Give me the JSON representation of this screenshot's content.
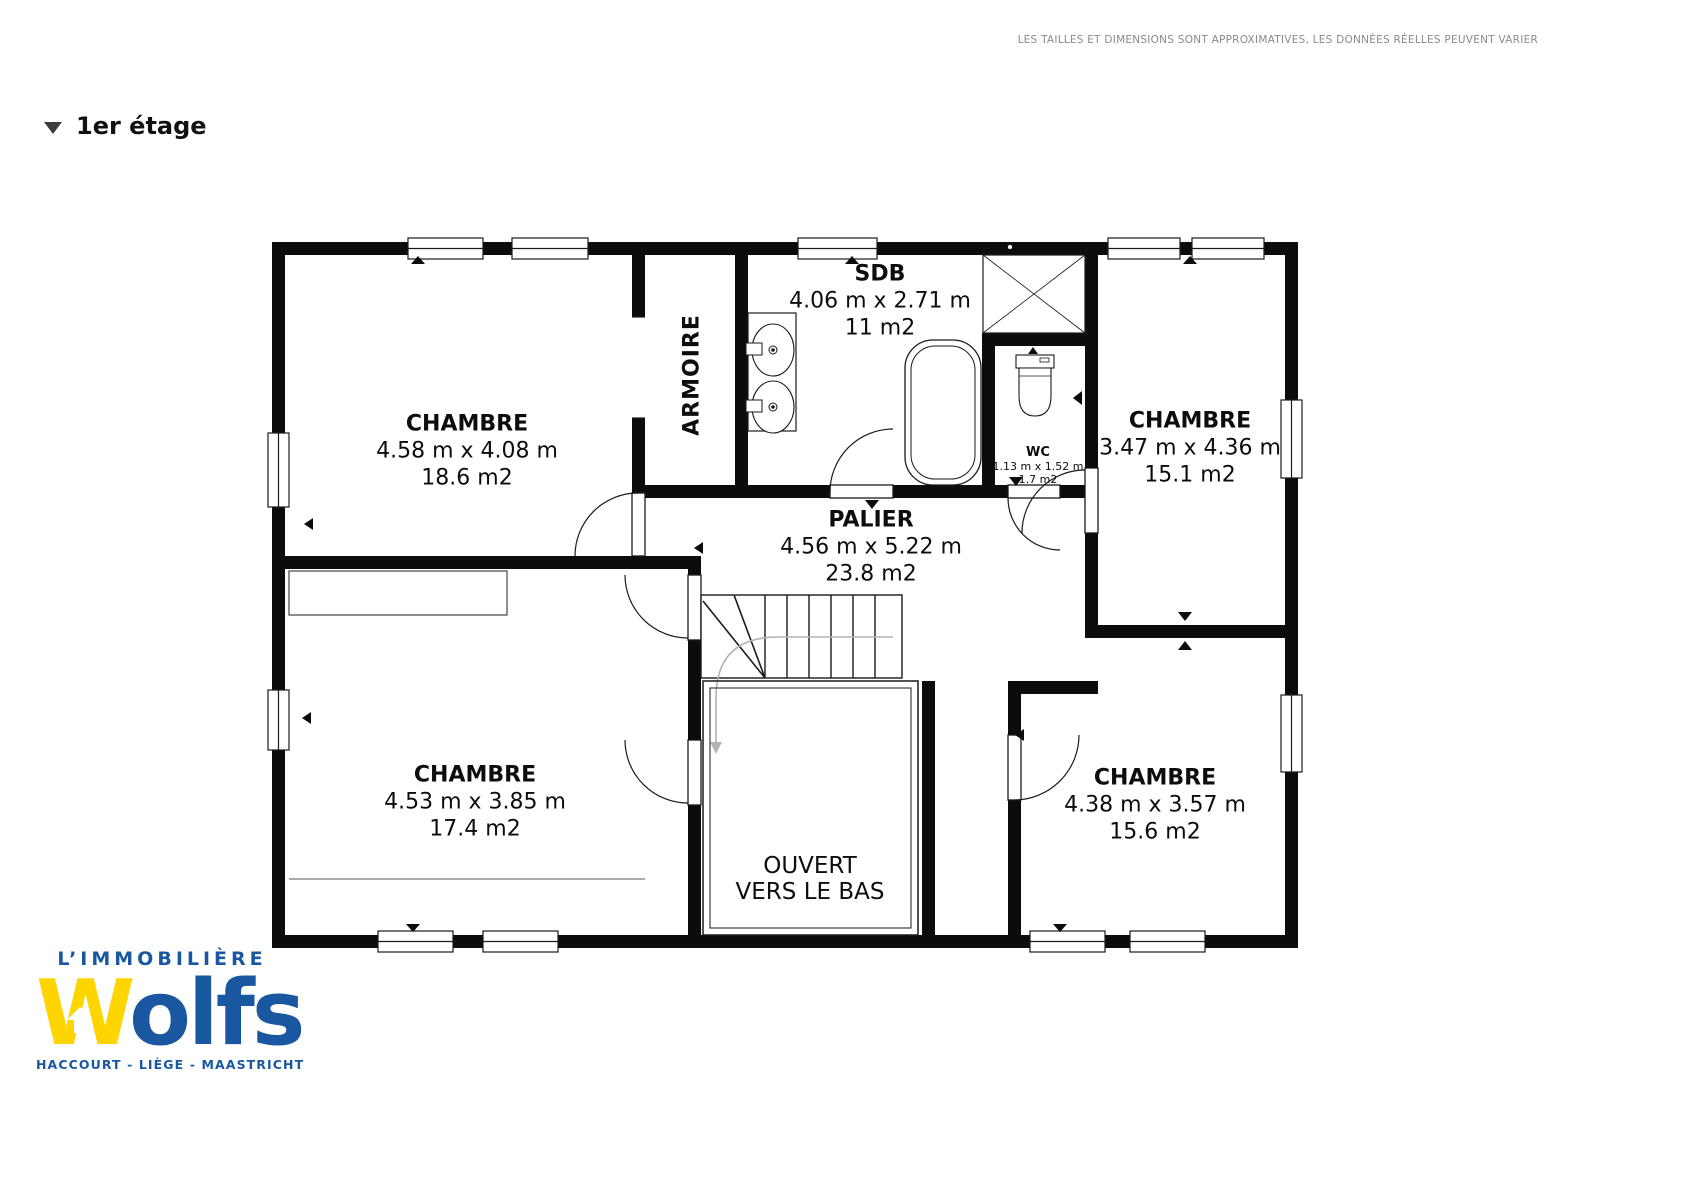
{
  "disclaimer": "LES TAILLES ET DIMENSIONS SONT APPROXIMATIVES, LES DONNÉES RÉELLES PEUVENT VARIER",
  "floor_selector": {
    "label": "1er étage"
  },
  "plan": {
    "rooms": [
      {
        "id": "chambre-top-left",
        "name": "CHAMBRE",
        "dims": "4.58 m x 4.08 m",
        "area": "18.6 m2"
      },
      {
        "id": "sdb",
        "name": "SDB",
        "dims": "4.06 m x 2.71 m",
        "area": "11 m2"
      },
      {
        "id": "wc",
        "name": "WC",
        "dims": "1.13 m x 1.52 m",
        "area": "1.7 m2"
      },
      {
        "id": "chambre-top-right",
        "name": "CHAMBRE",
        "dims": "3.47 m x 4.36 m",
        "area": "15.1 m2"
      },
      {
        "id": "palier",
        "name": "PALIER",
        "dims": "4.56 m x 5.22 m",
        "area": "23.8 m2"
      },
      {
        "id": "chambre-bottom-left",
        "name": "CHAMBRE",
        "dims": "4.53 m x 3.85 m",
        "area": "17.4 m2"
      },
      {
        "id": "chambre-bottom-right",
        "name": "CHAMBRE",
        "dims": "4.38 m x 3.57 m",
        "area": "15.6 m2"
      }
    ],
    "closet_label": "ARMOIRE",
    "void_label": {
      "line1": "OUVERT",
      "line2": "VERS LE BAS"
    }
  },
  "logo": {
    "tagline": "L’IMMOBILIÈRE",
    "brand_w": "W",
    "brand_rest": "olfs",
    "cities": "HACCOURT - LIÈGE - MAASTRICHT",
    "colors": {
      "blue": "#1a57a1",
      "yellow": "#ffd500"
    }
  },
  "icons": {
    "floor_selector_marker": "triangle-down",
    "logo_house": "house-up-arrow",
    "swing_markers": "small-black-triangles"
  }
}
